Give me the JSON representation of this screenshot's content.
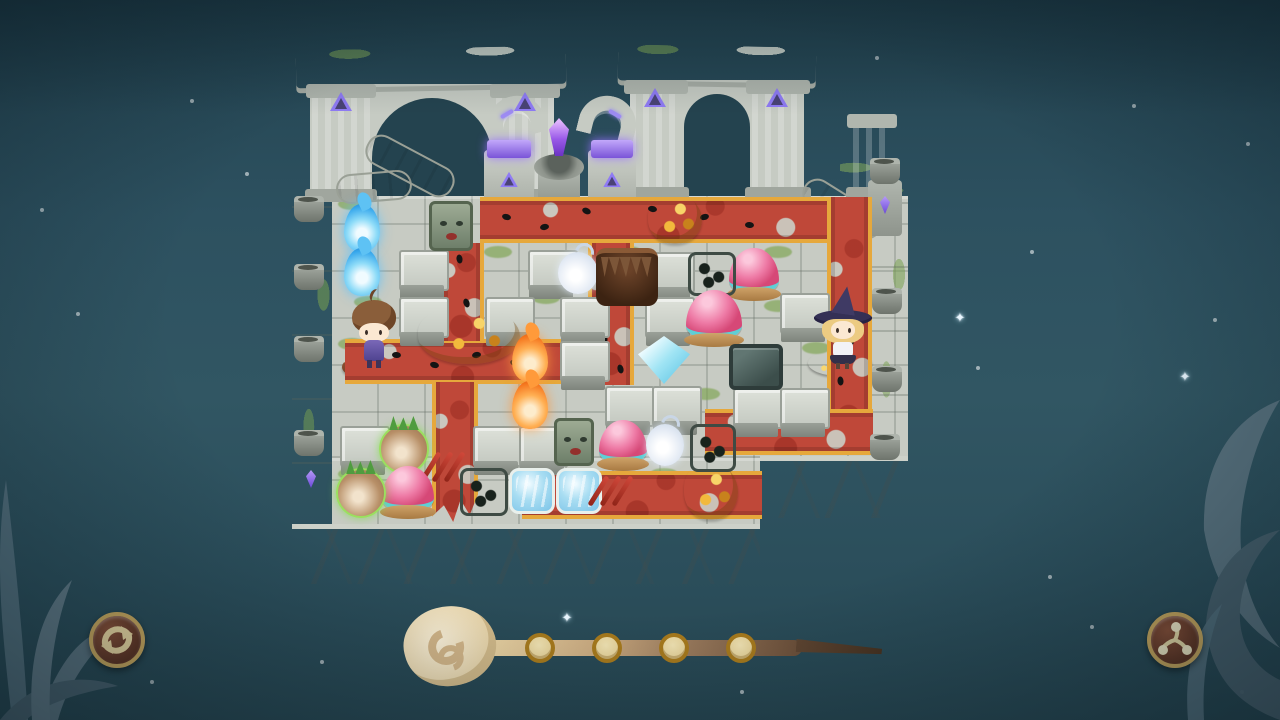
{
  "app": {
    "kind": "isometric-ruins-puzzle-game",
    "visible_text": "none"
  },
  "palette": {
    "sky": "#2d5160",
    "floor": "#c7cbc3",
    "stone_light": "#dde1d9",
    "stone_dark": "#8f958d",
    "cliff": "#a3a9a7",
    "moss": "#7ca34f",
    "carpet_red": "#bf4839",
    "carpet_trim_gold": "#e6a83c",
    "rune_purple": "#8f7bf4",
    "crystal_purple": "#9a5ae8",
    "button_face": "#6e3d28",
    "button_ring": "#c9a85e",
    "icon_cream": "#ecd9a2",
    "wand_light": "#eed9a8",
    "wand_dark": "#46311f",
    "slot_fill": "#e9d69e",
    "slot_ring": "#a87a1c"
  },
  "hud": {
    "restart_button": {
      "x": 89,
      "y": 612,
      "size": 56,
      "icon": "restart-arrows-icon"
    },
    "spin_button": {
      "x": 1147,
      "y": 612,
      "size": 56,
      "icon": "triskelion-icon"
    },
    "wand": {
      "slot_count": 4,
      "slots_filled": 0,
      "slot_centers": [
        [
          540,
          648
        ],
        [
          607,
          648
        ],
        [
          674,
          648
        ],
        [
          741,
          648
        ]
      ]
    }
  },
  "stars": [
    {
      "x": 190,
      "y": 99,
      "t": "dot"
    },
    {
      "x": 245,
      "y": 172,
      "t": "dot"
    },
    {
      "x": 76,
      "y": 312,
      "t": "dot"
    },
    {
      "x": 40,
      "y": 208,
      "t": "dot"
    },
    {
      "x": 875,
      "y": 56,
      "t": "dot"
    },
    {
      "x": 1132,
      "y": 104,
      "t": "dot"
    },
    {
      "x": 1246,
      "y": 142,
      "t": "dot"
    },
    {
      "x": 1213,
      "y": 318,
      "t": "dot"
    },
    {
      "x": 1178,
      "y": 371,
      "t": "sparkle"
    },
    {
      "x": 953,
      "y": 312,
      "t": "sparkle"
    },
    {
      "x": 976,
      "y": 366,
      "t": "dot"
    },
    {
      "x": 648,
      "y": 264,
      "t": "sparkle"
    },
    {
      "x": 410,
      "y": 117,
      "t": "sparkle"
    },
    {
      "x": 1048,
      "y": 575,
      "t": "dot"
    },
    {
      "x": 1090,
      "y": 625,
      "t": "dot"
    },
    {
      "x": 560,
      "y": 612,
      "t": "sparkle"
    },
    {
      "x": 740,
      "y": 690,
      "t": "dot"
    },
    {
      "x": 320,
      "y": 660,
      "t": "dot"
    },
    {
      "x": 150,
      "y": 680,
      "t": "dot"
    },
    {
      "x": 1240,
      "y": 690,
      "t": "dot"
    },
    {
      "x": 1030,
      "y": 250,
      "t": "dot"
    }
  ],
  "board": {
    "base": {
      "walkway": {
        "x": 292,
        "y": 158,
        "w": 520,
        "h": 40
      },
      "walkway_right": {
        "x": 840,
        "y": 160,
        "w": 68,
        "h": 38
      },
      "left_wall": {
        "x": 292,
        "y": 196,
        "w": 42,
        "h": 330
      },
      "floor_main": {
        "x": 332,
        "y": 196,
        "w": 576,
        "h": 262
      },
      "floor_lower": {
        "x": 332,
        "y": 458,
        "w": 428,
        "h": 68
      },
      "right_ledge": {
        "x": 872,
        "y": 196,
        "w": 36,
        "h": 262
      },
      "cliff_left": {
        "x": 292,
        "y": 524,
        "w": 468,
        "h": 60
      },
      "cliff_right": {
        "x": 760,
        "y": 456,
        "w": 148,
        "h": 62
      }
    },
    "carpets": [
      {
        "x": 480,
        "y": 197,
        "w": 392,
        "h": 46,
        "dir": "h"
      },
      {
        "x": 827,
        "y": 197,
        "w": 45,
        "h": 258,
        "dir": "v"
      },
      {
        "x": 705,
        "y": 409,
        "w": 168,
        "h": 46,
        "dir": "h"
      },
      {
        "x": 588,
        "y": 243,
        "w": 46,
        "h": 142,
        "dir": "v"
      },
      {
        "x": 345,
        "y": 339,
        "w": 245,
        "h": 45,
        "dir": "h"
      },
      {
        "x": 440,
        "y": 243,
        "w": 44,
        "h": 98,
        "dir": "v"
      },
      {
        "x": 432,
        "y": 382,
        "w": 46,
        "h": 140,
        "dir": "v",
        "torn": true
      },
      {
        "x": 522,
        "y": 471,
        "w": 240,
        "h": 48,
        "dir": "h"
      }
    ],
    "footprints": [
      [
        502,
        214,
        15
      ],
      [
        540,
        224,
        -10
      ],
      [
        582,
        208,
        25
      ],
      [
        648,
        206,
        10
      ],
      [
        700,
        214,
        -15
      ],
      [
        745,
        222,
        5
      ],
      [
        604,
        260,
        75
      ],
      [
        612,
        298,
        70
      ],
      [
        600,
        336,
        85
      ],
      [
        616,
        366,
        75
      ],
      [
        392,
        352,
        5
      ],
      [
        430,
        362,
        15
      ],
      [
        472,
        352,
        -10
      ],
      [
        510,
        360,
        20
      ],
      [
        840,
        298,
        80
      ],
      [
        846,
        338,
        70
      ],
      [
        836,
        378,
        85
      ],
      [
        762,
        422,
        5
      ],
      [
        802,
        430,
        15
      ],
      [
        455,
        256,
        80
      ],
      [
        462,
        300,
        70
      ]
    ],
    "blocks": [
      [
        399,
        250
      ],
      [
        399,
        297
      ],
      [
        528,
        250
      ],
      [
        485,
        297
      ],
      [
        560,
        297
      ],
      [
        645,
        252
      ],
      [
        645,
        297
      ],
      [
        560,
        341
      ],
      [
        605,
        386
      ],
      [
        652,
        386
      ],
      [
        733,
        388
      ],
      [
        780,
        388
      ],
      [
        780,
        293
      ],
      [
        340,
        426
      ],
      [
        473,
        426
      ],
      [
        519,
        426
      ]
    ],
    "moss_patches": [
      [
        338,
        198
      ],
      [
        354,
        296
      ],
      [
        338,
        338
      ],
      [
        484,
        246
      ],
      [
        532,
        292
      ],
      [
        614,
        246
      ],
      [
        702,
        292
      ],
      [
        764,
        246
      ],
      [
        802,
        342
      ],
      [
        692,
        388
      ],
      [
        544,
        432
      ],
      [
        434,
        416
      ],
      [
        650,
        468
      ],
      [
        764,
        300
      ],
      [
        338,
        468
      ],
      [
        600,
        196
      ],
      [
        470,
        430
      ]
    ],
    "pots": [
      [
        294,
        196
      ],
      [
        294,
        264
      ],
      [
        294,
        336
      ],
      [
        294,
        430
      ],
      [
        872,
        288
      ],
      [
        872,
        366
      ],
      [
        870,
        434
      ]
    ],
    "items": [
      {
        "type": "blue-flame",
        "x": 344,
        "y": 204,
        "w": 36,
        "h": 48
      },
      {
        "type": "blue-flame",
        "x": 344,
        "y": 248,
        "w": 36,
        "h": 48
      },
      {
        "type": "orange-flame",
        "x": 512,
        "y": 334,
        "w": 36,
        "h": 48
      },
      {
        "type": "orange-flame",
        "x": 512,
        "y": 381,
        "w": 36,
        "h": 48
      },
      {
        "type": "smoke-wisp",
        "x": 558,
        "y": 252,
        "w": 40,
        "h": 42
      },
      {
        "type": "smoke-wisp",
        "x": 646,
        "y": 424,
        "w": 38,
        "h": 42
      },
      {
        "type": "stone-face",
        "x": 429,
        "y": 201,
        "w": 44,
        "h": 50
      },
      {
        "type": "stone-face",
        "x": 554,
        "y": 418,
        "w": 40,
        "h": 48
      },
      {
        "type": "leaf-pile",
        "x": 648,
        "y": 194,
        "w": 54,
        "h": 50
      },
      {
        "type": "leaf-pile",
        "x": 418,
        "y": 306,
        "w": 102,
        "h": 58
      },
      {
        "type": "leaf-pile",
        "x": 684,
        "y": 462,
        "w": 54,
        "h": 58
      },
      {
        "type": "burrow",
        "x": 596,
        "y": 248,
        "w": 62,
        "h": 58
      },
      {
        "type": "dice-block",
        "x": 688,
        "y": 252,
        "w": 48,
        "h": 44
      },
      {
        "type": "dice-block",
        "x": 690,
        "y": 424,
        "w": 46,
        "h": 48
      },
      {
        "type": "dice-block",
        "x": 460,
        "y": 468,
        "w": 48,
        "h": 48
      },
      {
        "type": "metal-block",
        "x": 729,
        "y": 344,
        "w": 54,
        "h": 46
      },
      {
        "type": "slime",
        "x": 729,
        "y": 248,
        "w": 50,
        "h": 46
      },
      {
        "type": "slime",
        "x": 686,
        "y": 290,
        "w": 56,
        "h": 50
      },
      {
        "type": "slime",
        "x": 599,
        "y": 420,
        "w": 48,
        "h": 44
      },
      {
        "type": "slime",
        "x": 382,
        "y": 466,
        "w": 52,
        "h": 46
      },
      {
        "type": "turnip",
        "x": 379,
        "y": 424,
        "w": 50,
        "h": 50
      },
      {
        "type": "turnip",
        "x": 336,
        "y": 468,
        "w": 50,
        "h": 50
      },
      {
        "type": "ice-crystal",
        "x": 638,
        "y": 336,
        "w": 52,
        "h": 48
      },
      {
        "type": "water-tile",
        "x": 509,
        "y": 468,
        "w": 46,
        "h": 46
      },
      {
        "type": "water-tile",
        "x": 556,
        "y": 468,
        "w": 46,
        "h": 46
      },
      {
        "type": "claw-marks",
        "x": 428,
        "y": 450,
        "w": 40,
        "h": 56
      },
      {
        "type": "claw-marks",
        "x": 596,
        "y": 474,
        "w": 44,
        "h": 48
      },
      {
        "type": "pedestal-brown",
        "x": 342,
        "y": 354,
        "w": 62,
        "h": 26
      },
      {
        "type": "boy",
        "x": 350,
        "y": 298,
        "w": 48,
        "h": 72
      },
      {
        "type": "pedestal-pink",
        "x": 808,
        "y": 350,
        "w": 64,
        "h": 26
      },
      {
        "type": "witch",
        "x": 814,
        "y": 288,
        "w": 58,
        "h": 82
      }
    ]
  }
}
